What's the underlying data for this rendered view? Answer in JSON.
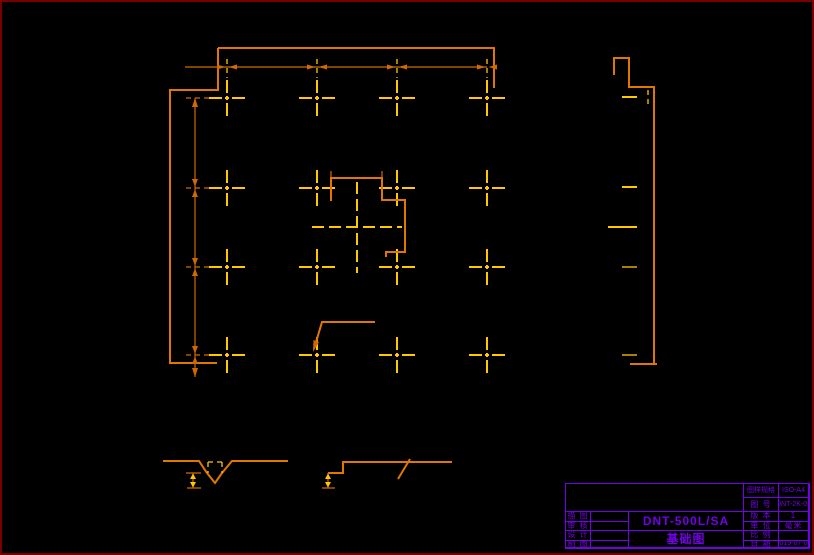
{
  "window": {
    "width": 814,
    "height": 555
  },
  "theme": {
    "background": "#000000",
    "border_red": "#7a0000",
    "line_orange": "#e07800",
    "dim_orange": "#d06a00",
    "mark_yellow": "#ffc800",
    "violet": "#7300e6"
  },
  "drawing": {
    "description": "foundation-plan",
    "anchor_columns": [
      227,
      317,
      397,
      487
    ],
    "anchor_rows": [
      98,
      188,
      267,
      355
    ],
    "right_edge_dash_rows": [
      97,
      187,
      227,
      267,
      355
    ]
  },
  "title_block": {
    "paper_label": "图样规格",
    "paper_value": "ISO-A4",
    "drawing_no_label": "图 号",
    "drawing_no_value": "DNT-2K-01",
    "version_label": "版 本",
    "version_value": "1",
    "unit_label": "单 位",
    "unit_value": "毫米",
    "scale_label": "比 例",
    "scale_value": "",
    "date_label": "日 期",
    "date_value": "2019-07-03",
    "sign_rows": [
      {
        "label": "描 图"
      },
      {
        "label": "审 核"
      },
      {
        "label": "设 计"
      },
      {
        "label": "制 图"
      }
    ],
    "model": "DNT-500L/SA",
    "drawing_title": "基础图"
  }
}
